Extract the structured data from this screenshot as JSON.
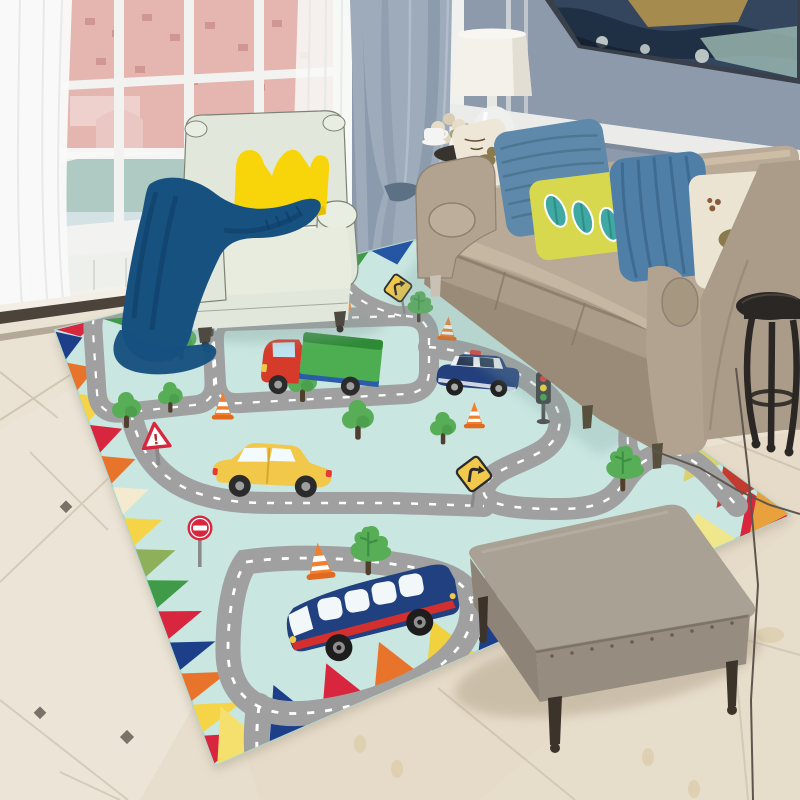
{
  "meta": {
    "description": "Living-room product photo: kids traffic road play rug with toy vehicles, mint armchair, beige sofa, gray ottoman, marble tile floor",
    "objects": [
      "window",
      "sheer-curtains",
      "gray-drape-curtain",
      "wall-painting",
      "table-lamp",
      "flower-bouquet",
      "coffee-cup",
      "armchair",
      "crown-pillow",
      "navy-throw-blanket",
      "sofa",
      "throw-pillows",
      "dark-side-table",
      "kids-road-play-rug",
      "toy-truck",
      "toy-police-car",
      "toy-yellow-car",
      "toy-orange-car",
      "toy-bus",
      "cartoon-trees",
      "traffic-cones",
      "traffic-lights",
      "road-signs",
      "ottoman",
      "marble-tile-floor",
      "power-cable"
    ]
  },
  "wall": {
    "paint": "#8d9aab",
    "paint_shadow": "#7c8b9d",
    "rail": "#ebecea",
    "rail_shadow": "#6f7e8f",
    "corner_trim": "#f0f1ef",
    "molding_line": "#dfe2e2"
  },
  "painting": {
    "frame": "#39404a",
    "base": "#33465e",
    "dark": "#1e2e41",
    "gold": "#b3924c",
    "mist": "#9fbdb4",
    "snow": "#d6ded8"
  },
  "window": {
    "glow": "#f3efe8",
    "frame": "#f2f3f1",
    "building": "#e2aba6",
    "building_dark": "#c5827d",
    "building_light": "#efd3cf",
    "foliage": "#a3c3bb",
    "haze": "#cfdfe2",
    "rail": "#f7f8f6",
    "sill": "#eef0ec",
    "slat": "#d9dad3"
  },
  "curtains": {
    "sheer": "#f8f9f8",
    "sheer_fold": "#e3e6e4",
    "drape": "#9dabbb",
    "drape_shadow": "#7f8fa1",
    "drape_light": "#b9c4d0",
    "knot": "#5d7185"
  },
  "floor": {
    "tile": "#eae2d3",
    "tile_bright": "#f4efe6",
    "tile_warm": "#e2d7c2",
    "grout": "#cec3af",
    "border_dark": "#4c443b",
    "border_light": "#a99f8e",
    "footprint": "#d9c7a0"
  },
  "armchair": {
    "fabric": "#e1e7da",
    "fabric_light": "#e9eee2",
    "fabric_shadow": "#c6d0bf",
    "piping": "#7c8274",
    "feet": "#4e4a42"
  },
  "crown_pillow": {
    "fill": "#f8d50b",
    "shade": "#d9b406"
  },
  "blanket": {
    "fill": "#175180",
    "shade": "#0f3e64"
  },
  "sofa": {
    "fabric": "#b9aa97",
    "cushion_top": "#c6b7a3",
    "cushion_front": "#ab9c89",
    "fabric_shadow": "#8f8171",
    "base": "#9a8b79",
    "arm": "#b2a390",
    "side": "#ab9c89",
    "legs": "#57503f"
  },
  "pillows": {
    "bird_left": {
      "fill": "#eee7d8",
      "bird": "#8a7a4e",
      "accent": "#5d5132"
    },
    "blue_weave": {
      "fill": "#5e89ab",
      "lines": "#49748f"
    },
    "leaf": {
      "fill": "#d8d84e",
      "leaf": "#3fa8a2",
      "leaf_dark": "#2f8c86"
    },
    "blue_pleat": {
      "fill": "#4f7ea7",
      "lines": "#3d688e"
    },
    "bird_right": {
      "fill": "#ece4d3",
      "bird": "#8a7a4e"
    }
  },
  "lamp": {
    "shade": "#f3f1ea",
    "shade_shadow": "#ddd9cd",
    "shade_top": "#f8f6f0",
    "base": "#eef0ed",
    "table": "#37342e",
    "flowers": "#e7dcc6",
    "flowers2": "#d9cdb4",
    "greens": "#9aa77a",
    "cup": "#f4f4f2"
  },
  "side_table": {
    "wood": "#2b2724",
    "highlight": "#574e45"
  },
  "ottoman": {
    "top": "#aaa195",
    "front": "#968c7f",
    "side": "#8d8477",
    "welt": "#7d7468",
    "legs": "#3c342b",
    "studs": "#685e52"
  },
  "cable": "#5d564d",
  "rug": {
    "background": "#c9e6e1",
    "edge": "#b2d6cf",
    "shadow": "#8fa8a2",
    "road": "#a0a0a0",
    "road_line": "#ffffff",
    "border": {
      "top": [
        "#d7263d",
        "#3f9b47",
        "#2456a4",
        "#e8742c",
        "#f2d13f",
        "#d7263d",
        "#3f9b47",
        "#2456a4"
      ],
      "left": [
        "#1d3f8a",
        "#e8742c",
        "#f5d547",
        "#d7263d",
        "#e8742c",
        "#f3ead0",
        "#f5d547",
        "#8fb05a",
        "#3f9b47",
        "#d7263d",
        "#1d3f8a",
        "#e8742c",
        "#f5d547",
        "#d7263d"
      ],
      "bottom": [
        "#f5e06e",
        "#1d3f8a",
        "#d7263d",
        "#e8742c",
        "#f2d13f",
        "#1d3f8a",
        "#d7263d",
        "#e8742c",
        "#8aa84a",
        "#f0e68c",
        "#d7263d"
      ],
      "right": [
        "#d7263d",
        "#2a9d8f",
        "#1d3f8a",
        "#f5d547",
        "#8aa84a",
        "#d7263d",
        "#e8742c",
        "#1d3f8a",
        "#d9d070",
        "#c23b2e",
        "#e8a13c"
      ]
    },
    "tree": {
      "foliage": "#58ad57",
      "foliage_dark": "#3c8f42",
      "trunk": "#4f3f2c"
    },
    "cone": {
      "body": "#f07f2e",
      "stripe": "#ffffff",
      "base": "#e06a20"
    },
    "traffic_light": {
      "housing": "#3b3b3b",
      "red": "#e53935",
      "yellow": "#fdd835",
      "green": "#43a047",
      "pole": "#555555"
    },
    "signs": {
      "warning_fill": "#ffffff",
      "warning_border": "#d7263d",
      "warning_glyph": "!",
      "no_entry_fill": "#d7263d",
      "no_entry_bar": "#ffffff",
      "diamond_fill": "#f2c94c",
      "diamond_border": "#2b2b2b",
      "pole": "#8a8a8a"
    },
    "vehicles": {
      "truck": {
        "cab": "#d63a2a",
        "cab_dark": "#b02a1c",
        "box": "#4cae50",
        "box_dark": "#2e8b35",
        "chassis": "#2a5caa",
        "window": "#bfe3f0",
        "wheel": "#2b2b2b",
        "hub": "#9e9e9e",
        "light": "#f2c84b"
      },
      "police": {
        "body": "#24407c",
        "roof": "#eef2f5",
        "window": "#2b3a55",
        "light": "#e53935",
        "wheel": "#222222",
        "hub": "#aaaaaa"
      },
      "car_yellow": {
        "body": "#f2c84b",
        "body_dark": "#d9a72e",
        "window": "#f4fbff",
        "wheel": "#2b2b2b",
        "hub": "#9e9e9e",
        "light": "#e53935"
      },
      "car_orange": {
        "body": "#ef8b3a",
        "window": "#f4fbff",
        "wheel": "#2b2b2b"
      },
      "bus": {
        "body": "#20407f",
        "body_dark": "#16305f",
        "stripe": "#d32f2f",
        "window": "#f2f7fa",
        "wheel": "#1d1d1d",
        "hub": "#8f8f8f",
        "light": "#f2c84b"
      }
    }
  }
}
